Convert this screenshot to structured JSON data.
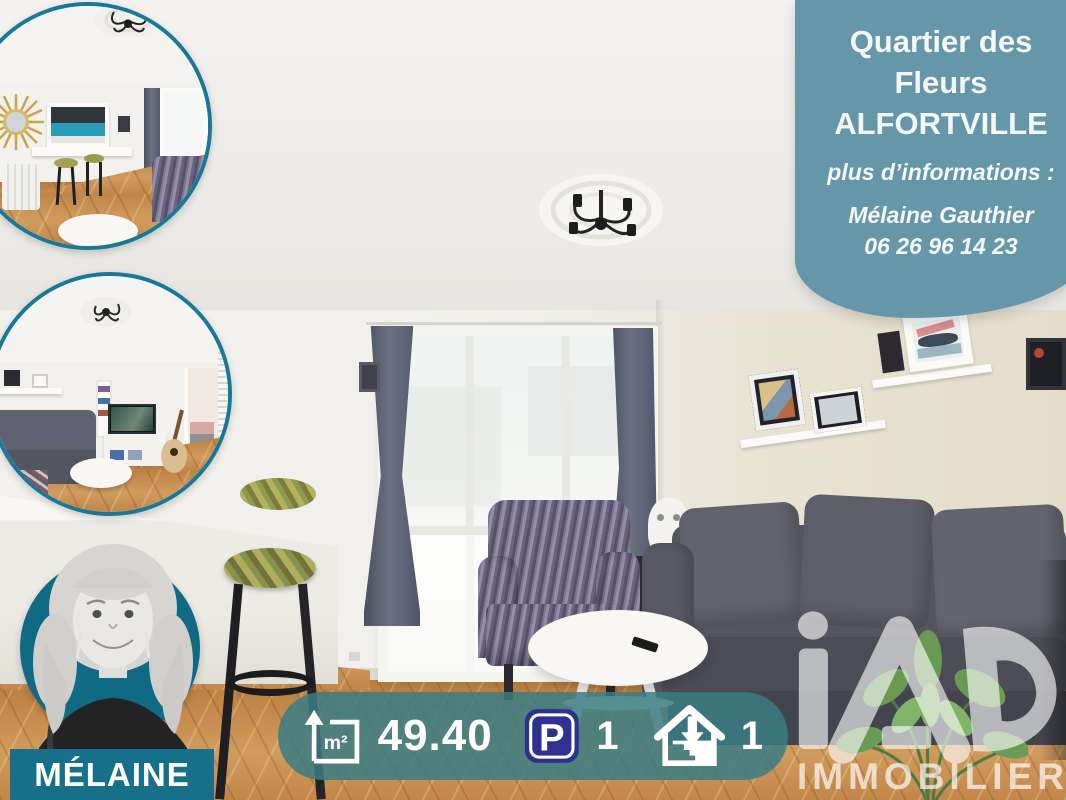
{
  "theme": {
    "banner-bg": "#6597a9",
    "teal-border": "#187896",
    "teal-dark": "#116a84",
    "teal-banner": "#17708a",
    "statsbar-bg": "rgba(58,125,132,0.85)",
    "parking-navy": "#2e3192",
    "text-white": "#f5f7f6"
  },
  "top_banner": {
    "line1": "Quartier des",
    "line2": "Fleurs",
    "city": "ALFORTVILLE",
    "info": "plus d’informations :",
    "agent": "Mélaine Gauthier",
    "phone": "06 26 96 14 23"
  },
  "agent_badge": {
    "name": "MÉLAINE"
  },
  "stats_bar": {
    "area_unit": "m²",
    "area_value": "49.40",
    "parking_letter": "P",
    "parking_count": "1",
    "cellar_count": "1"
  },
  "brand": {
    "name": "iad",
    "sub": "IMMOBILIER"
  }
}
